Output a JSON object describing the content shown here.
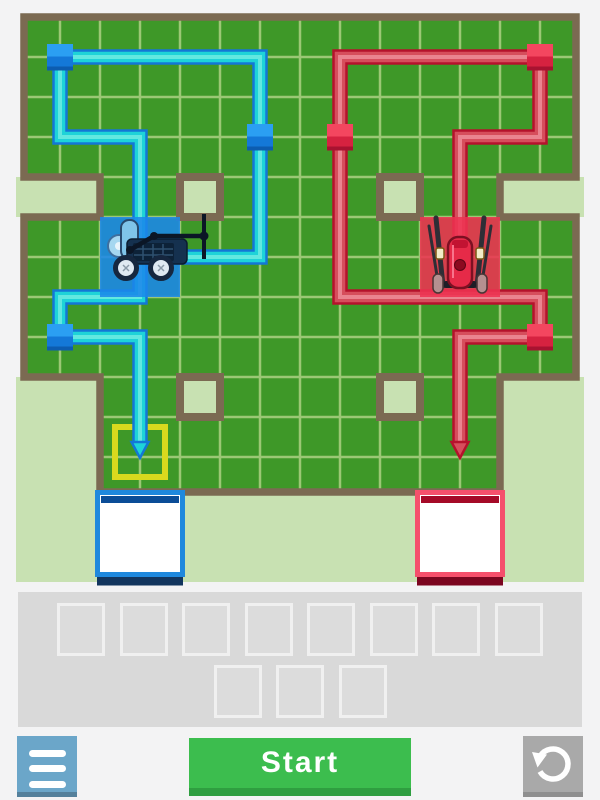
{
  "colors": {
    "page_bg": "#f3f3f4",
    "outside": "#c8e1b2",
    "field": "#3e9828",
    "grid_line": "#9bc875",
    "wall": "#7b6a52",
    "highlight": "#d9d91e",
    "tray_bg": "#d9d9d9",
    "slot_fill": "#dcdcdc",
    "slot_border": "#f0f0f0",
    "btn_menu": "#6ba6c9",
    "btn_menu_edge": "#54809b",
    "btn_start": "#3cbd4e",
    "btn_start_edge": "#2f9e40",
    "btn_reset": "#a9a9a9",
    "btn_reset_edge": "#8f8f8f",
    "btn_icon": "#ffffff",
    "blue": {
      "home": "#1b87ea",
      "path_edge": "#1377d6",
      "path_fill": "#1ed3d8",
      "path_core": "#62e8e0",
      "node_top": "#2b9ff2",
      "node_front": "#1478d8",
      "node_lip": "#0c5cb0",
      "goal_border": "#1e88dd",
      "goal_stripe": "#0b4d97",
      "goal_shadow": "#12355e"
    },
    "red": {
      "home": "#ee3352",
      "path_edge": "#b5122c",
      "path_fill": "#d64e5c",
      "path_core": "#ea8490",
      "node_top": "#f4465f",
      "node_front": "#d62240",
      "node_lip": "#a81230",
      "goal_border": "#f5506c",
      "goal_stripe": "#a50a28",
      "goal_shadow": "#7c0620"
    }
  },
  "board": {
    "width": 600,
    "height": 592,
    "grid": {
      "origin_x": 20,
      "origin_y": 17,
      "cell": 40,
      "cols": 14,
      "rows": 12
    },
    "field_polygon": [
      [
        24,
        17
      ],
      [
        576,
        17
      ],
      [
        576,
        177
      ],
      [
        500,
        177
      ],
      [
        500,
        217
      ],
      [
        576,
        217
      ],
      [
        576,
        377
      ],
      [
        500,
        377
      ],
      [
        500,
        492
      ],
      [
        100,
        492
      ],
      [
        100,
        377
      ],
      [
        24,
        377
      ],
      [
        24,
        217
      ],
      [
        100,
        217
      ],
      [
        100,
        177
      ],
      [
        24,
        177
      ]
    ],
    "outside_rects": [
      [
        16,
        177,
        84,
        40
      ],
      [
        500,
        177,
        84,
        40
      ],
      [
        16,
        377,
        84,
        205
      ],
      [
        500,
        377,
        84,
        205
      ],
      [
        100,
        495,
        400,
        87
      ]
    ],
    "pits": [
      [
        180,
        177
      ],
      [
        380,
        177
      ],
      [
        180,
        377
      ],
      [
        380,
        377
      ]
    ],
    "highlight_cell": [
      115,
      427,
      50,
      50
    ],
    "teams": {
      "blue": {
        "home": [
          100,
          217,
          80,
          80
        ],
        "robot_center": [
          140,
          257
        ],
        "path_points": [
          [
            140,
            257
          ],
          [
            260,
            257
          ],
          [
            260,
            57
          ],
          [
            60,
            57
          ],
          [
            60,
            137
          ],
          [
            140,
            137
          ],
          [
            140,
            297
          ],
          [
            60,
            297
          ],
          [
            60,
            337
          ],
          [
            140,
            337
          ],
          [
            140,
            445
          ]
        ],
        "arrow_tip": [
          140,
          458
        ],
        "nodes": [
          [
            60,
            57
          ],
          [
            260,
            137
          ],
          [
            60,
            337
          ]
        ],
        "goal": [
          95,
          490,
          90,
          87
        ]
      },
      "red": {
        "home": [
          420,
          217,
          80,
          80
        ],
        "robot_center": [
          460,
          257
        ],
        "path_points": [
          [
            460,
            257
          ],
          [
            460,
            137
          ],
          [
            540,
            137
          ],
          [
            540,
            57
          ],
          [
            340,
            57
          ],
          [
            340,
            297
          ],
          [
            540,
            297
          ],
          [
            540,
            337
          ],
          [
            460,
            337
          ],
          [
            460,
            445
          ]
        ],
        "arrow_tip": [
          460,
          458
        ],
        "nodes": [
          [
            540,
            57
          ],
          [
            340,
            137
          ],
          [
            540,
            337
          ]
        ],
        "goal": [
          415,
          490,
          90,
          87
        ]
      }
    }
  },
  "tray": {
    "slot_rows": [
      8,
      3
    ]
  },
  "controls": {
    "menu": {
      "icon": "menu-icon"
    },
    "start": {
      "label": "Start"
    },
    "reset": {
      "icon": "reset-undo-icon"
    }
  }
}
